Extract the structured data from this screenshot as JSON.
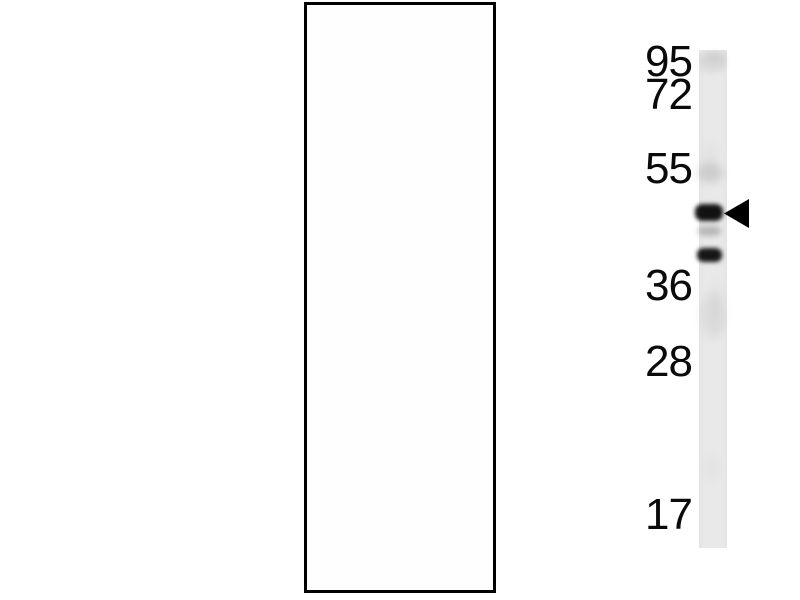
{
  "figure": {
    "kind": "western-blot-panel",
    "colors": {
      "page_background": "#ffffff",
      "panel_background": "#fefefe",
      "panel_border": "#000000",
      "lane": "#e9e9e9",
      "band_strong": "#121212",
      "band_faint": "#8f8f8f",
      "arrow": "#000000",
      "label_text": "#0a0a0a"
    },
    "markers": [
      {
        "label": "95"
      },
      {
        "label": "72"
      },
      {
        "label": "55"
      },
      {
        "label": "36"
      },
      {
        "label": "28"
      },
      {
        "label": "17"
      }
    ],
    "lane": {
      "count": 1,
      "description": "single light-gray vertical lane strip"
    },
    "bands": [
      {
        "name": "main-band",
        "intensity": "strong",
        "position": "between 55 and 36 markers, marked by arrow"
      },
      {
        "name": "faint-band",
        "intensity": "very-faint",
        "position": "immediately below main band"
      },
      {
        "name": "lower-band",
        "intensity": "medium",
        "position": "just above 36 marker"
      }
    ],
    "arrow": {
      "direction": "left",
      "points_at": "main-band"
    }
  }
}
